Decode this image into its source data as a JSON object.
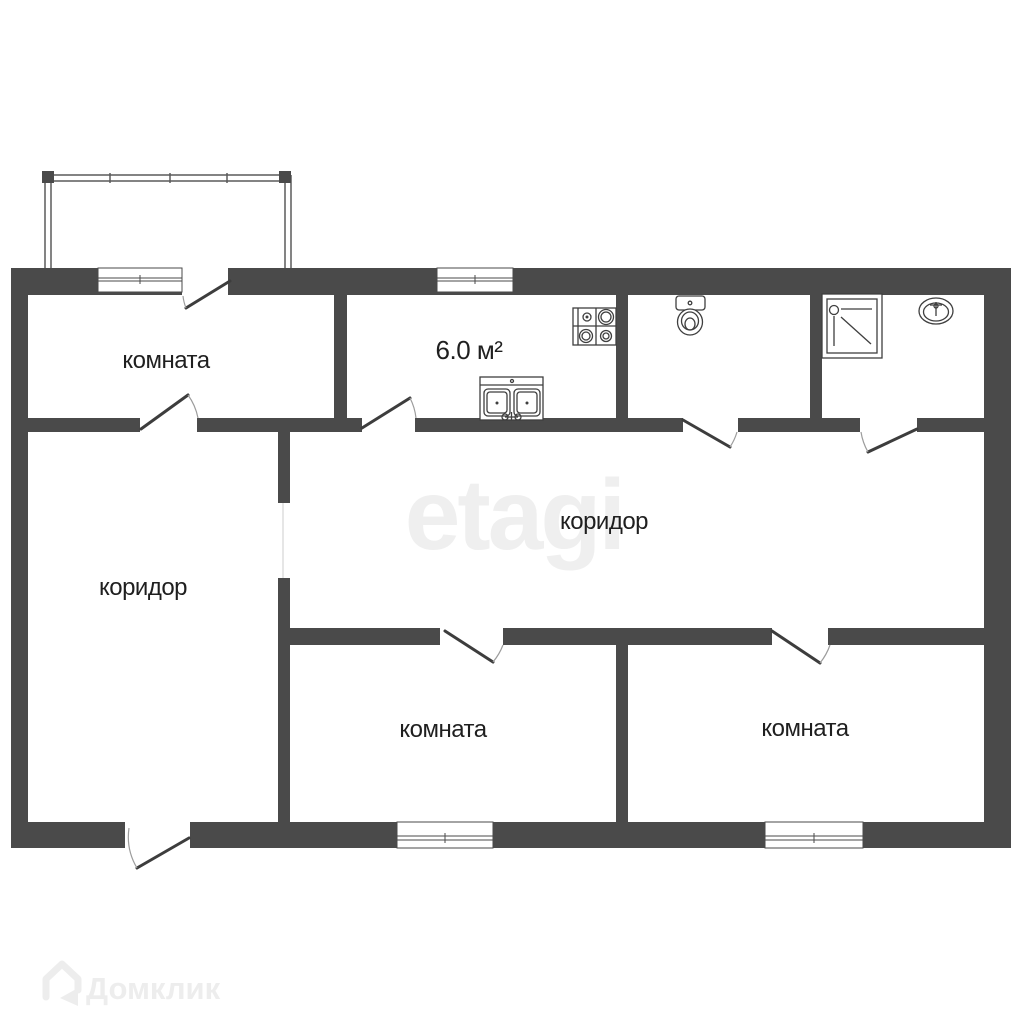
{
  "plan": {
    "labels": {
      "room_top_left": "комната",
      "kitchen_area": "6.0 м²",
      "corridor_main": "коридор",
      "corridor_left": "коридор",
      "room_bottom_middle": "комната",
      "room_bottom_right": "комната"
    },
    "fixtures": {
      "stove": "stove-icon",
      "kitchen_sink": "kitchen-sink-icon",
      "toilet": "toilet-icon",
      "shower": "shower-icon",
      "washbasin": "washbasin-icon",
      "balcony": "balcony-glazing"
    },
    "watermark_text": "etagi",
    "brand_logo_text": "Домклик"
  },
  "colors": {
    "wall": "#4a4a4a",
    "door_line": "#3d3d3d",
    "arc_line": "#9c9c9c",
    "fixture_line": "#3f3f3f",
    "label_text": "#1f1f1f",
    "watermark": "#efefef",
    "logo": "#ededed",
    "background": "#ffffff"
  }
}
